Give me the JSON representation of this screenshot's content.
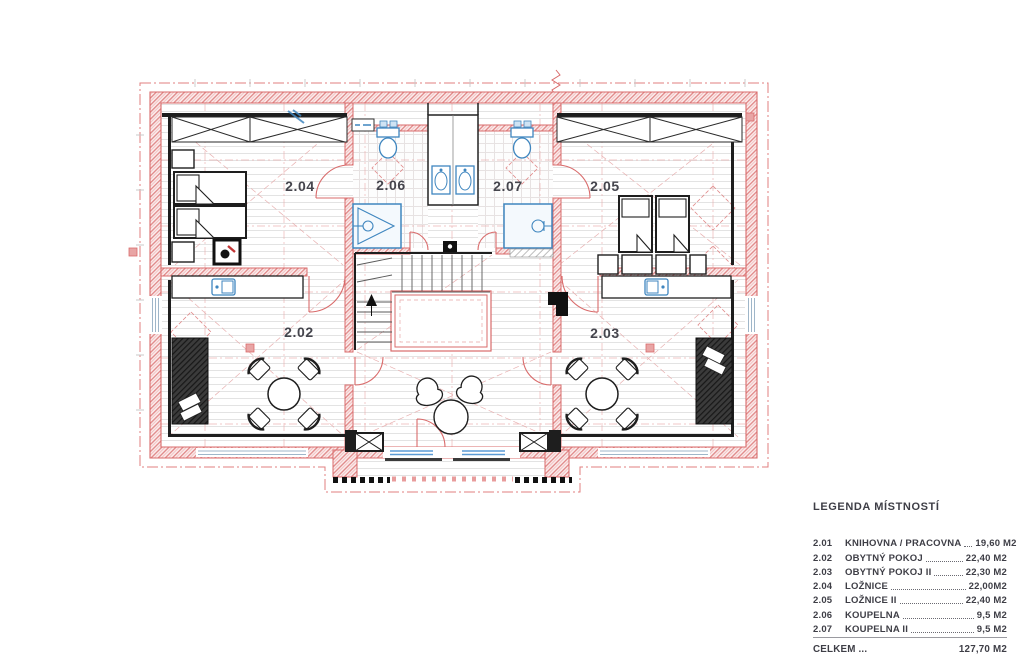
{
  "plan": {
    "room_labels": [
      {
        "id": "2.04",
        "label": "2.04"
      },
      {
        "id": "2.06",
        "label": "2.06"
      },
      {
        "id": "2.07",
        "label": "2.07"
      },
      {
        "id": "2.05",
        "label": "2.05"
      },
      {
        "id": "2.02",
        "label": "2.02"
      },
      {
        "id": "2.03",
        "label": "2.03"
      }
    ]
  },
  "legend": {
    "title": "LEGENDA MÍSTNOSTÍ",
    "rows": [
      {
        "num": "2.01",
        "name": "KNIHOVNA / PRACOVNA",
        "area": "19,60 M2"
      },
      {
        "num": "2.02",
        "name": "OBYTNÝ POKOJ",
        "area": "22,40 M2"
      },
      {
        "num": "2.03",
        "name": "OBYTNÝ POKOJ II",
        "area": "22,30 M2"
      },
      {
        "num": "2.04",
        "name": "LOŽNICE",
        "area": "22,00M2"
      },
      {
        "num": "2.05",
        "name": "LOŽNICE II",
        "area": "22,40 M2"
      },
      {
        "num": "2.06",
        "name": "KOUPELNA",
        "area": "9,5 M2"
      },
      {
        "num": "2.07",
        "name": "KOUPELNA II",
        "area": "9,5 M2"
      }
    ],
    "total_label": "CELKEM ...",
    "total_area": "127,70 M2"
  },
  "colors": {
    "wall_red": "#d96b6b",
    "grid_pink": "#eaa9a9",
    "fixture_blue": "#3f86bf",
    "ink": "#1e1e1e",
    "label_text": "#45454d"
  }
}
